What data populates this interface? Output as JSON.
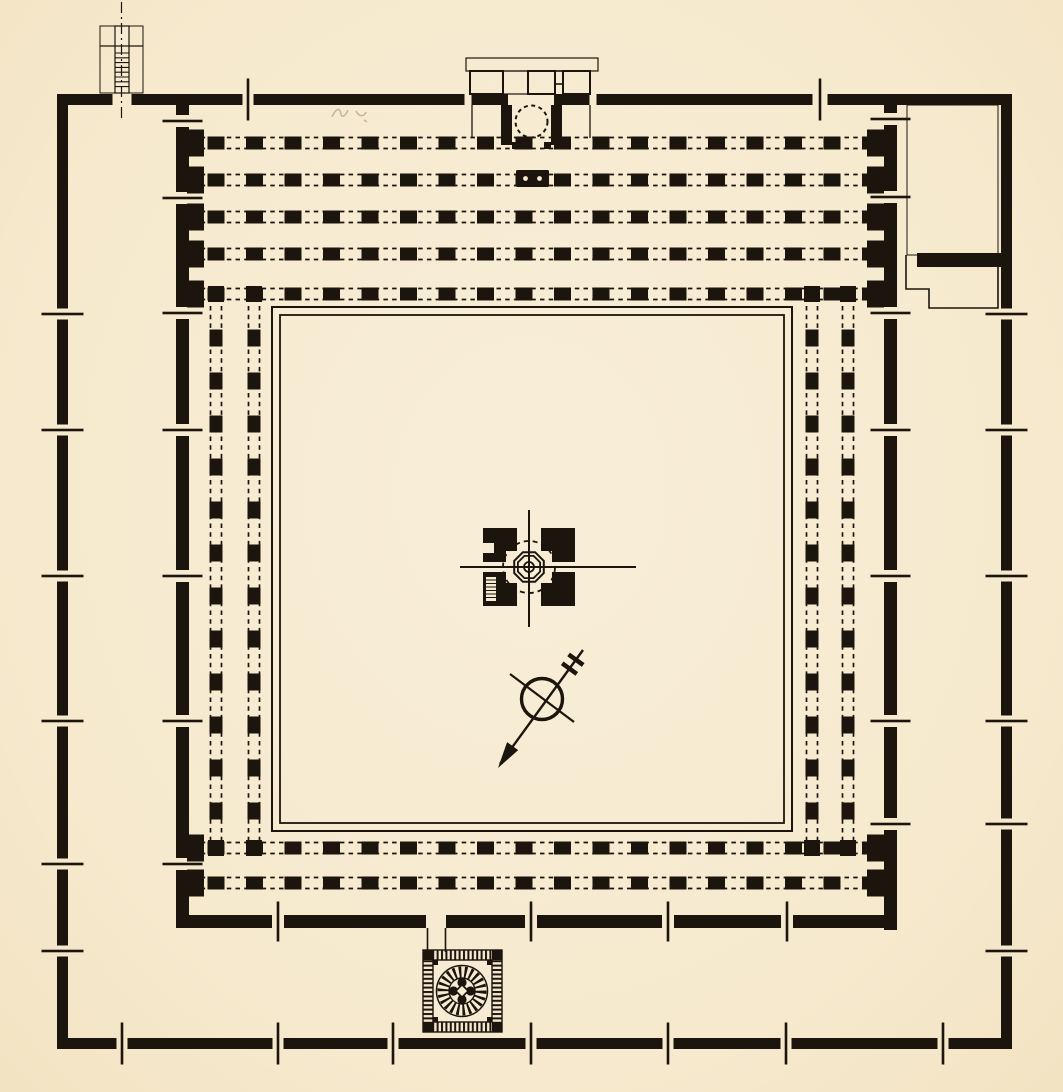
{
  "meta": {
    "title": "Ground plan of a hypostyle courtyard mosque",
    "description": "Printed black-ink line drawing on cream paper: square enclosure with gated outer wall, inner hypostyle hall of pier colonnades around an open courtyard, mihrab projecting from the qibla wall at top, central fountain pavilion, orientation arrow, hatched corner annex, water-shaft annex and a square spiral-stair minaret in the south ziyada."
  },
  "palette": {
    "paper": "#f7ecd3",
    "ink": "#1c150d",
    "pencil": "#8f7d63"
  },
  "structures": {
    "prayer_hall": "Hypostyle prayer hall, five pier rows",
    "riwaqs": "Arcaded galleries, two pier rows per side",
    "courtyard": "Central courtyard (sahn)",
    "mihrab": "Mihrab projection on qibla wall",
    "minbar": "Minbar pier with two sockets",
    "well": "Water-shaft annex, north-west",
    "corner_annex": "Hatched corner annex, north-east",
    "fountain": "Central ablution fountain pavilion",
    "north_arrow": "Orientation arrow",
    "minaret": "Square minaret with spiral stair, south ziyada",
    "pencil_note": "Faint pencil annotation"
  },
  "plan": {
    "canvas": {
      "w": 1063,
      "h": 1092
    },
    "walls": [
      {
        "name": "outer-north",
        "o": "h",
        "c": 99.5,
        "t": 11,
        "a": 57,
        "b": 1012,
        "tick": 42,
        "gaps": [
          [
            122,
            19,
            0
          ],
          [
            248,
            11,
            1
          ],
          [
            468,
            7,
            0
          ],
          [
            531,
            46,
            0
          ],
          [
            593,
            7,
            0
          ],
          [
            820,
            15,
            1
          ]
        ]
      },
      {
        "name": "outer-west",
        "o": "v",
        "c": 62.5,
        "t": 11,
        "a": 94,
        "b": 1049,
        "tick": 42,
        "gaps": [
          [
            314,
            11,
            1
          ],
          [
            430,
            11,
            1
          ],
          [
            576,
            11,
            1
          ],
          [
            721,
            11,
            1
          ],
          [
            864,
            11,
            1
          ],
          [
            951,
            11,
            1
          ]
        ]
      },
      {
        "name": "outer-east",
        "o": "v",
        "c": 1006.5,
        "t": 11,
        "a": 94,
        "b": 1049,
        "tick": 42,
        "gaps": [
          [
            314,
            11,
            1
          ],
          [
            430,
            11,
            1
          ],
          [
            576,
            11,
            1
          ],
          [
            721,
            11,
            1
          ],
          [
            824,
            11,
            1
          ],
          [
            951,
            11,
            1
          ]
        ]
      },
      {
        "name": "outer-south",
        "o": "h",
        "c": 1043.5,
        "t": 11,
        "a": 57,
        "b": 1012,
        "tick": 42,
        "gaps": [
          [
            122,
            11,
            1
          ],
          [
            278,
            11,
            1
          ],
          [
            393,
            11,
            1
          ],
          [
            531,
            11,
            1
          ],
          [
            668,
            11,
            1
          ],
          [
            786,
            11,
            1
          ],
          [
            943,
            11,
            1
          ]
        ]
      },
      {
        "name": "inner-west",
        "o": "v",
        "c": 182.5,
        "t": 13,
        "a": 105,
        "b": 928,
        "tick": 40,
        "gaps": [
          [
            121,
            12,
            1
          ],
          [
            198,
            12,
            1
          ],
          [
            313,
            12,
            1
          ],
          [
            430,
            12,
            1
          ],
          [
            576,
            12,
            1
          ],
          [
            721,
            12,
            1
          ],
          [
            864,
            12,
            1
          ]
        ]
      },
      {
        "name": "inner-east",
        "o": "v",
        "c": 890.5,
        "t": 13,
        "a": 105,
        "b": 930,
        "tick": 40,
        "gaps": [
          [
            119,
            12,
            1
          ],
          [
            197,
            12,
            1
          ],
          [
            313,
            12,
            1
          ],
          [
            430,
            12,
            1
          ],
          [
            576,
            12,
            1
          ],
          [
            721,
            12,
            1
          ],
          [
            824,
            12,
            1
          ]
        ]
      },
      {
        "name": "inner-south",
        "o": "h",
        "c": 921.5,
        "t": 13,
        "a": 176,
        "b": 897,
        "tick": 40,
        "gaps": [
          [
            278,
            12,
            1
          ],
          [
            436,
            20,
            0
          ],
          [
            531,
            12,
            1
          ],
          [
            668,
            12,
            1
          ],
          [
            787,
            12,
            1
          ]
        ]
      }
    ],
    "colonnades": [
      {
        "name": "prayer-hall-rows",
        "o": "h",
        "centers": [
          143,
          180,
          217,
          254,
          294
        ],
        "la": 192,
        "lb": 884,
        "ps": 216,
        "pe": 871,
        "pitch": 38.5,
        "pw": 17,
        "ph": 13,
        "off": 5.5
      },
      {
        "name": "south-riwaq-rows",
        "o": "h",
        "centers": [
          848,
          883
        ],
        "la": 192,
        "lb": 884,
        "ps": 216,
        "pe": 871,
        "pitch": 38.5,
        "pw": 17,
        "ph": 13,
        "off": 5.5
      },
      {
        "name": "west-riwaq-rows",
        "o": "v",
        "centers": [
          216,
          254
        ],
        "la": 306,
        "lb": 842,
        "ps": 338,
        "pe": 815,
        "pitch": 43,
        "pw": 13,
        "ph": 17,
        "off": 5.5
      },
      {
        "name": "east-riwaq-rows",
        "o": "v",
        "centers": [
          812,
          848
        ],
        "la": 306,
        "lb": 842,
        "ps": 338,
        "pe": 815,
        "pitch": 43,
        "pw": 13,
        "ph": 17,
        "off": 5.5
      }
    ],
    "engaged_piers": {
      "rows": [
        143,
        180,
        217,
        254,
        294,
        848,
        883
      ],
      "west_x": 187,
      "east_x": 867,
      "w": 17,
      "h": 27
    },
    "junction_piers": {
      "size": 16,
      "points": [
        [
          216,
          294
        ],
        [
          254,
          294
        ],
        [
          812,
          294
        ],
        [
          848,
          294
        ],
        [
          216,
          848
        ],
        [
          254,
          848
        ],
        [
          812,
          848
        ],
        [
          848,
          848
        ]
      ]
    },
    "courtyard": {
      "outer": [
        272,
        307,
        520,
        524
      ],
      "inner": [
        280,
        315,
        504,
        508
      ]
    },
    "row_dash": "4.5 4.2",
    "row_line_w": 1.7
  }
}
